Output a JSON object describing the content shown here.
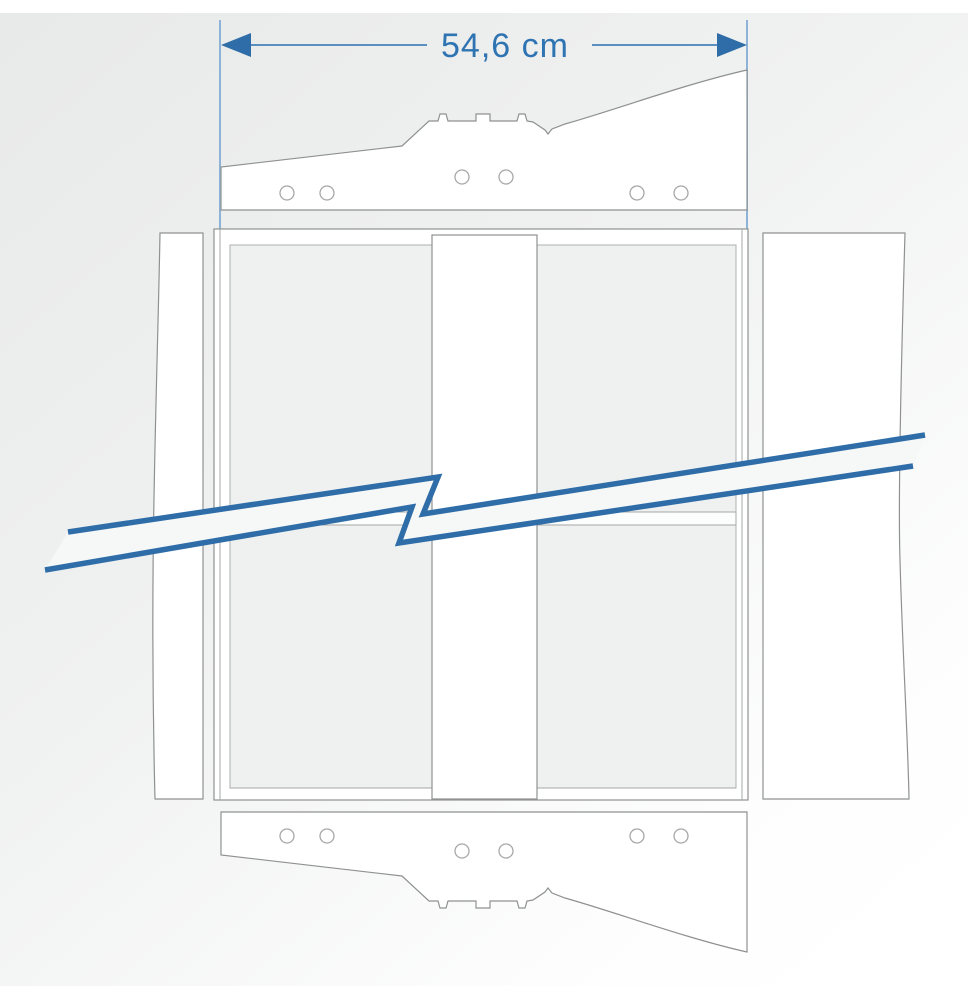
{
  "diagram": {
    "type": "technical-drawing",
    "dimension": {
      "label": "54,6 cm",
      "unit": "cm",
      "value": "54,6"
    },
    "parts": [
      {
        "name": "top-ledger-bracket",
        "holes": 6
      },
      {
        "name": "bottom-ledger-bracket",
        "holes": 6
      },
      {
        "name": "frame-assembly",
        "stiles": 2,
        "rails": 3
      },
      {
        "name": "center-vertical-board"
      },
      {
        "name": "left-side-panel",
        "edge": "broken"
      },
      {
        "name": "right-side-panel",
        "edge": "broken"
      },
      {
        "name": "break-symbol",
        "style": "zigzag"
      }
    ]
  },
  "colors": {
    "accent_blue": "#2e6da8",
    "dimension_text": "#2f74b2",
    "dimension_line": "#5b8fc0",
    "extension_line": "#8fb3d6",
    "outline_gray": "#8f9191",
    "hole_stroke": "#a6a8a8",
    "panel_white": "#ffffff",
    "interior_gray": "#eff1f1",
    "break_band": "#f6f7f7",
    "background_from": "#e8e9e9",
    "background_to": "#ffffff"
  }
}
